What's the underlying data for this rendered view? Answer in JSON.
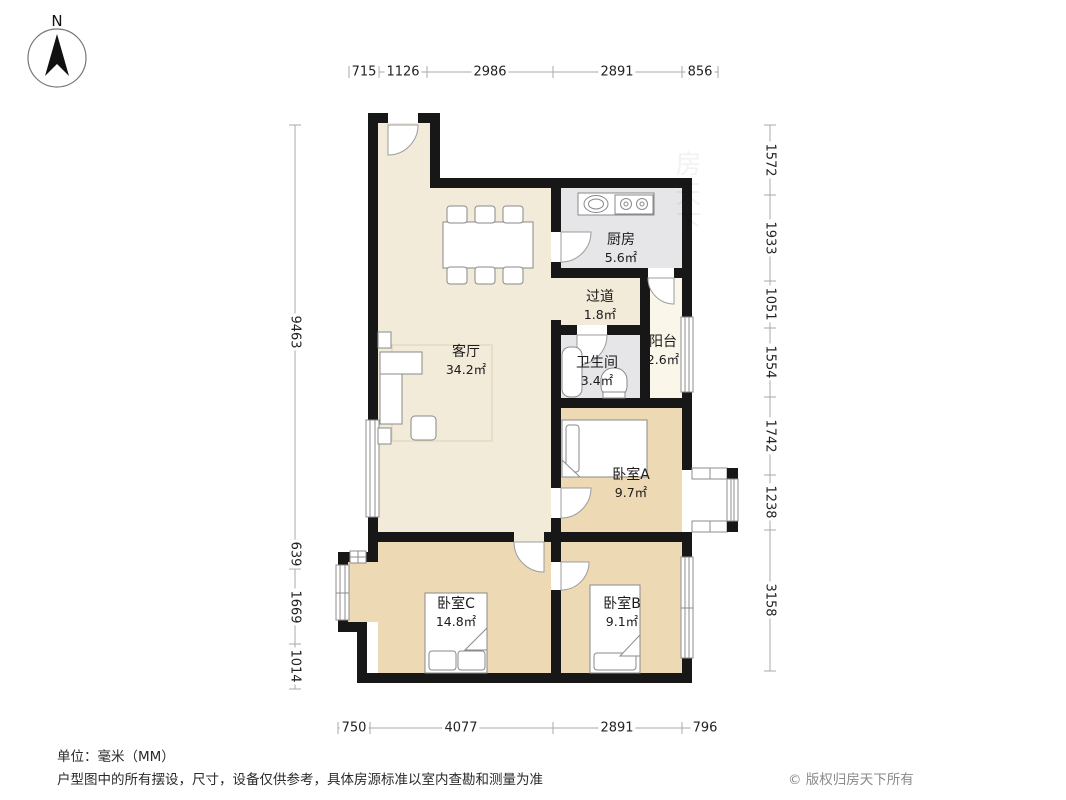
{
  "compass": {
    "label": "N"
  },
  "rooms": {
    "kitchen": {
      "name": "厨房",
      "area": "5.6㎡"
    },
    "hallway": {
      "name": "过道",
      "area": "1.8㎡"
    },
    "balcony": {
      "name": "阳台",
      "area": "2.6㎡"
    },
    "bathroom": {
      "name": "卫生间",
      "area": "3.4㎡"
    },
    "living": {
      "name": "客厅",
      "area": "34.2㎡"
    },
    "bedroomA": {
      "name": "卧室A",
      "area": "9.7㎡"
    },
    "bedroomB": {
      "name": "卧室B",
      "area": "9.1㎡"
    },
    "bedroomC": {
      "name": "卧室C",
      "area": "14.8㎡"
    }
  },
  "dimensions": {
    "top": [
      "715",
      "1126",
      "2986",
      "2891",
      "856"
    ],
    "bottom": [
      "750",
      "4077",
      "2891",
      "796"
    ],
    "left": [
      "9463",
      "639",
      "1669",
      "1014"
    ],
    "right": [
      "1572",
      "1933",
      "1051",
      "1554",
      "1742",
      "1238",
      "3158"
    ]
  },
  "footer": {
    "unit": "单位：毫米（MM）",
    "disclaimer": "户型图中的所有摆设，尺寸，设备仅供参考，具体房源标准以室内查勘和测量为准",
    "copyright": "© 版权归房天下所有"
  },
  "watermark": "房天下",
  "colors": {
    "wall": "#171717",
    "living_floor": "#f3ebd9",
    "bedroom_floor": "#edd9b4",
    "wet_floor": "#e6e6e9",
    "balcony_floor": "#faf6ea"
  }
}
